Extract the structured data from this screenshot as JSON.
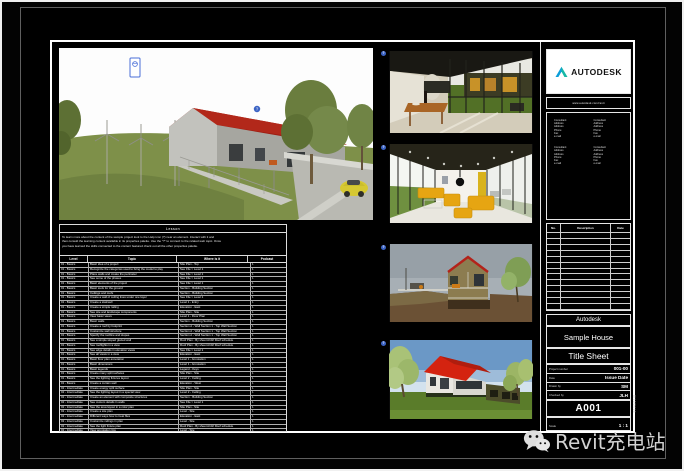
{
  "watermark": {
    "label": "Revit充电站"
  },
  "titleblock": {
    "brand": "AUTODESK",
    "brand_url": "www.autodesk.com/revit",
    "consultant_block_count": 4,
    "consultant_block_lines": [
      "Consultant",
      "Address",
      "Address",
      "Phone",
      "Fax",
      "e-mail"
    ],
    "revisions": {
      "headers": [
        "No.",
        "Description",
        "Date"
      ],
      "empty_row_count": 13
    },
    "client": "Autodesk",
    "project": "Sample House",
    "sheet_title": "Title Sheet",
    "fields": [
      {
        "label": "Project number",
        "value": "001-00"
      },
      {
        "label": "Date",
        "value": "Issue Date"
      },
      {
        "label": "Drawn by",
        "value": "SM"
      },
      {
        "label": "Checked by",
        "value": "JLH"
      }
    ],
    "sheet_number": "A001",
    "scale": {
      "label": "Scale",
      "value": "1 : 1"
    },
    "plot_stamp": "8/12/2016"
  },
  "schedule": {
    "title": "Lesson",
    "intro": [
      "To learn more about the content of the sample project look to the Help icon (?) near an element. Interact with it and",
      "then consult the learning content available in its properties palette. Use the \"?\" to connect to the related web topic. Once",
      "you have learned the skills connected to the content featured check out all the other properties palette."
    ],
    "headers": [
      "Level",
      "Topic",
      "Where is it",
      "Podcast"
    ],
    "rows": [
      [
        "01 - Basics",
        "Basic idea of a project",
        "Site Plan - Top",
        "1"
      ],
      [
        "01 - Basics",
        "Recognize the categories used to bring the model to play",
        "See File > Level 1",
        "1"
      ],
      [
        "01 - Basics",
        "Place walls and create the perimeter",
        "See File > Level 1",
        "1"
      ],
      [
        "01 - Basics",
        "See some of the phases",
        "See File > Level 1",
        "1"
      ],
      [
        "01 - Basics",
        "Basic elements of the project",
        "See File > Level 1",
        "1"
      ],
      [
        "01 - Basics",
        "Basic tools for the ground",
        "Section - Building Section",
        "1"
      ],
      [
        "01 - Basics",
        "Ceilings and roofs",
        "Section - Building Section",
        "1"
      ],
      [
        "01 - Basics",
        "Create a wall of ceiling lines under one layer",
        "See File > Level 1",
        "1"
      ],
      [
        "01 - Basics",
        "Create a stairwell",
        "Level 1 - Entry",
        "1"
      ],
      [
        "01 - Basics",
        "Create a simple railing",
        "Elevation - East",
        "1"
      ],
      [
        "01 - Basics",
        "See site and landscape components",
        "Site Plan - Site",
        "1"
      ],
      [
        "01 - Basics",
        "View basic views",
        "Level 1 - Floor Plan",
        "1"
      ],
      [
        "01 - Basics",
        "Basic walls",
        "Section - Building Section",
        "1"
      ],
      [
        "01 - Basics",
        "Create a roof by footprint",
        "Section A - Wall Section 1 - Top Wall Section",
        "1"
      ],
      [
        "01 - Basics",
        "Customize wall structure",
        "Section A - Wall Section 1 - Top Wall Section",
        "1"
      ],
      [
        "01 - Basics",
        "Specify the roofline and slopes",
        "Section A - Wall Section 1 - Top Wall Section",
        "1"
      ],
      [
        "01 - Basics",
        "See a simple sloped glazed wall",
        "Roof Plan - By sheet A102 Roof schedule",
        "1"
      ],
      [
        "01 - Basics",
        "See rooflights in a view",
        "Roof Plan - By sheet A102 Roof schedule",
        "1"
      ],
      [
        "01 - Basics",
        "See edge details in elevation views",
        "See File > Level 1",
        "1"
      ],
      [
        "01 - Basics",
        "See all views in a view",
        "Elevation - East",
        "1"
      ],
      [
        "01 - Basics",
        "Basic floor plan annotation",
        "Level 1 - Annotation",
        "1"
      ],
      [
        "01 - Basics",
        "Basic dimensions",
        "Level 1 - Annotation",
        "1"
      ],
      [
        "01 - Basics",
        "Basic legends",
        "Legend - Keys",
        "1"
      ],
      [
        "01 - Basics",
        "Create many split surfaces",
        "Site Plan - Site",
        "1"
      ],
      [
        "01 - Basics",
        "See the lighting fixtures layout",
        "Level 2 - Ceiling",
        "1"
      ],
      [
        "01 - Basics",
        "Create a curtain wall",
        "Elevation - West",
        "1"
      ],
      [
        "02 - Intermediate",
        "Create energy split surface",
        "Site Plan - Site",
        "1"
      ],
      [
        "02 - Intermediate",
        "See the lighting layout in a special view",
        "Level 2 - Ceiling",
        "1"
      ],
      [
        "02 - Intermediate",
        "Create an element with composite structures",
        "Section - Building Section",
        "1"
      ],
      [
        "02 - Intermediate",
        "See custom details in walls",
        "See File > Level 1",
        "1"
      ],
      [
        "02 - Intermediate",
        "See the area layout in a color plan",
        "Site Plan - Site",
        "1"
      ],
      [
        "02 - Intermediate",
        "Create a site plan",
        "Level - Site",
        "1"
      ],
      [
        "02 - Intermediate",
        "Different ways how to treat files",
        "Elevation - East",
        "1"
      ],
      [
        "02 - Intermediate",
        "Customize railings in plan",
        "Level - Site",
        "1"
      ],
      [
        "02 - Intermediate",
        "See the light fixture plan",
        "Roof Plan - By sheet A102 Roof schedule",
        "1"
      ],
      [
        "02 - Intermediate",
        "View annotation tips",
        "Level - Site",
        "1"
      ],
      [
        "02 - Intermediate",
        "Advanced views of the floors",
        "Level - Site",
        "1"
      ],
      [
        "02 - Intermediate",
        "Working with design options",
        "Level - Site",
        "1"
      ],
      [
        "03 - Advanced",
        "Create a costs schedule for colors",
        "See File > Level 1",
        "1"
      ],
      [
        "03 - Advanced",
        "See custom file types",
        "See File > Level 1",
        "1"
      ],
      [
        "03 - Advanced",
        "Control the use of families in the complex site views",
        "Section - Building Section",
        "1"
      ],
      [
        "03 - Advanced",
        "Design a variant as a final phase",
        "Elevation - East",
        "1"
      ],
      [
        "03 - Advanced",
        "See the very detailed shade & render",
        "Elevation - Part",
        "1"
      ],
      [
        "03 - Advanced",
        "Adjust advanced shape elements",
        "Level - Site",
        "1"
      ],
      [
        "03 - Advanced",
        "Render a project",
        "Level - Site",
        "1"
      ]
    ]
  }
}
